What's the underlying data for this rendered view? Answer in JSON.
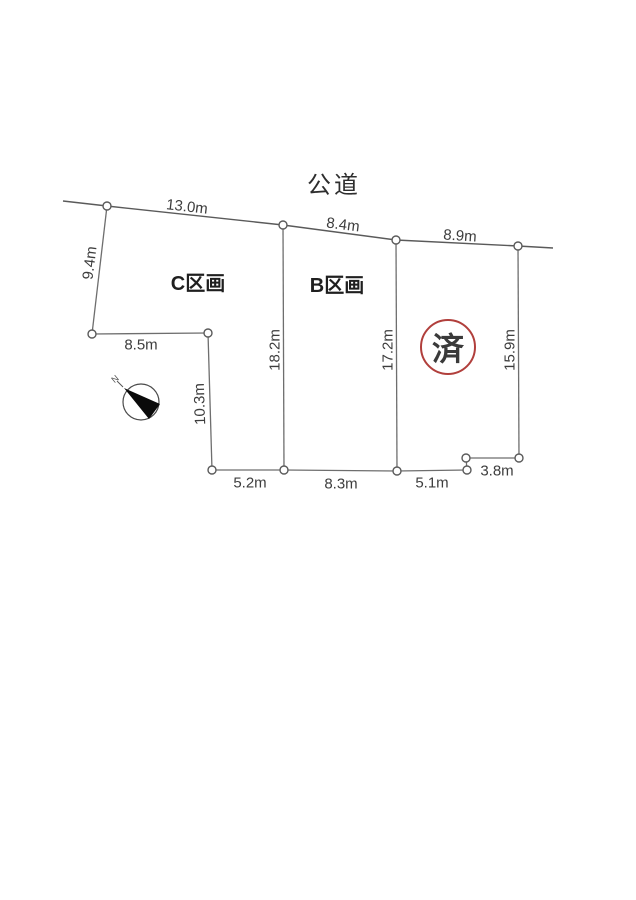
{
  "road": {
    "label": "公道"
  },
  "parcels": {
    "c": {
      "label": "C区画"
    },
    "b": {
      "label": "B区画"
    },
    "a": {
      "stamp": "済"
    }
  },
  "measurements": {
    "road_c": "13.0m",
    "road_b": "8.4m",
    "road_a": "8.9m",
    "west_upper": "9.4m",
    "west_mid": "8.5m",
    "west_lower": "10.3m",
    "divider_cb": "18.2m",
    "divider_ba": "17.2m",
    "east": "15.9m",
    "south_c": "5.2m",
    "south_b": "8.3m",
    "south_a": "5.1m",
    "south_a_step": "3.8m"
  },
  "compass": {
    "label": "N"
  },
  "colors": {
    "stamp_red": "#b13f3c"
  }
}
